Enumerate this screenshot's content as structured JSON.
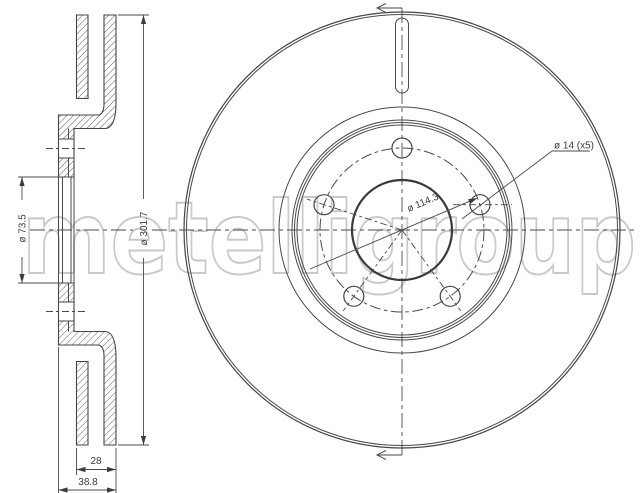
{
  "watermark": {
    "text": "metelligroup",
    "color": "#c9c9c9"
  },
  "colors": {
    "background": "#ffffff",
    "line": "#454545",
    "dim_text": "#3c3c3c"
  },
  "section_view": {
    "name": "brake disc cross section",
    "dims": {
      "bore": "ø 73.5",
      "outer_diameter": "ø 301.7",
      "disc_thickness": "28",
      "overall_width": "38.8"
    }
  },
  "front_view": {
    "name": "brake disc front view",
    "dims": {
      "bolt_holes": "ø 14 (x5)",
      "bolt_circle": "ø 114.3"
    }
  }
}
